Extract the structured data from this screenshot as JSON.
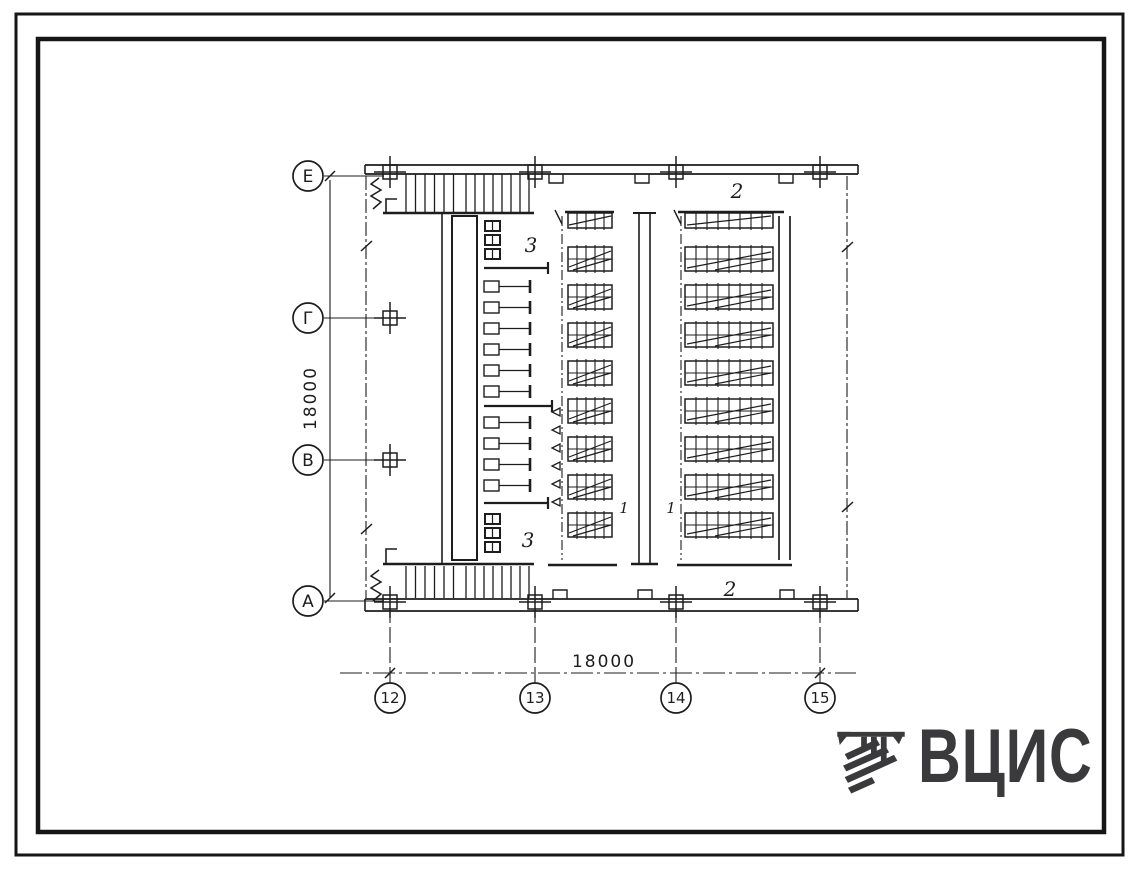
{
  "sheet": {
    "title": "floor-plan-drawing",
    "axes": {
      "rows": [
        "Е",
        "Г",
        "В",
        "А"
      ],
      "columns": [
        "12",
        "13",
        "14",
        "15"
      ]
    },
    "dimensions": {
      "vertical": "18000",
      "horizontal": "18000"
    },
    "rooms": {
      "corridor_top": "2",
      "corridor_bottom": "2",
      "room_top": "3",
      "room_bottom": "3",
      "hall_left": "1",
      "hall_right": "1"
    },
    "logo": {
      "text": "ВЦИС"
    },
    "colors": {
      "ink": "#1d1d1d",
      "logo": "#3a3a3d",
      "paper": "#ffffff"
    }
  }
}
